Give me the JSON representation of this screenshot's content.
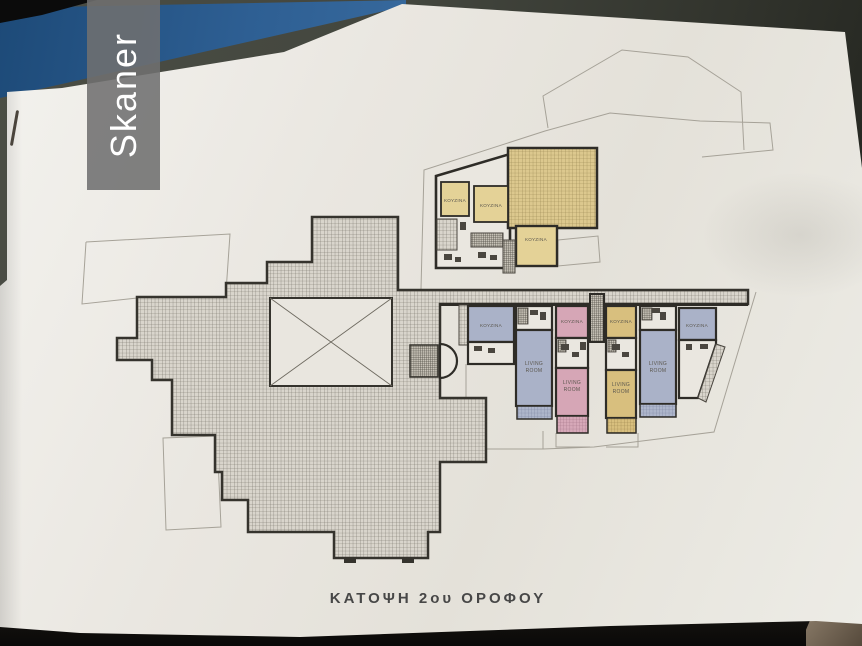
{
  "scanner_overlay": {
    "label": "Skaner"
  },
  "drawing": {
    "title": "ΚΑΤΟΨΗ 2ου ΟΡΟΦΟΥ",
    "labels": {
      "kitchen": "ΚΟΥΖΙΝΑ",
      "living_line1": "LIVING",
      "living_line2": "ROOM"
    },
    "rooms": {
      "kitchen_label_count": 7,
      "living_room_label_count": 4
    },
    "colors": {
      "paper": "#eae7e0",
      "wall_ink": "#2e2c27",
      "hatch_gray": "#d9d5cc",
      "terrace_yellow": "#dcc88e",
      "room_yellow": "#e4d297",
      "room_blue": "#aab2c8",
      "room_pink": "#d6a6b6",
      "row_yellow": "#d8bf7e",
      "cover_blue": "#2e5f93",
      "scanner_badge": "#6f6f6f"
    }
  }
}
